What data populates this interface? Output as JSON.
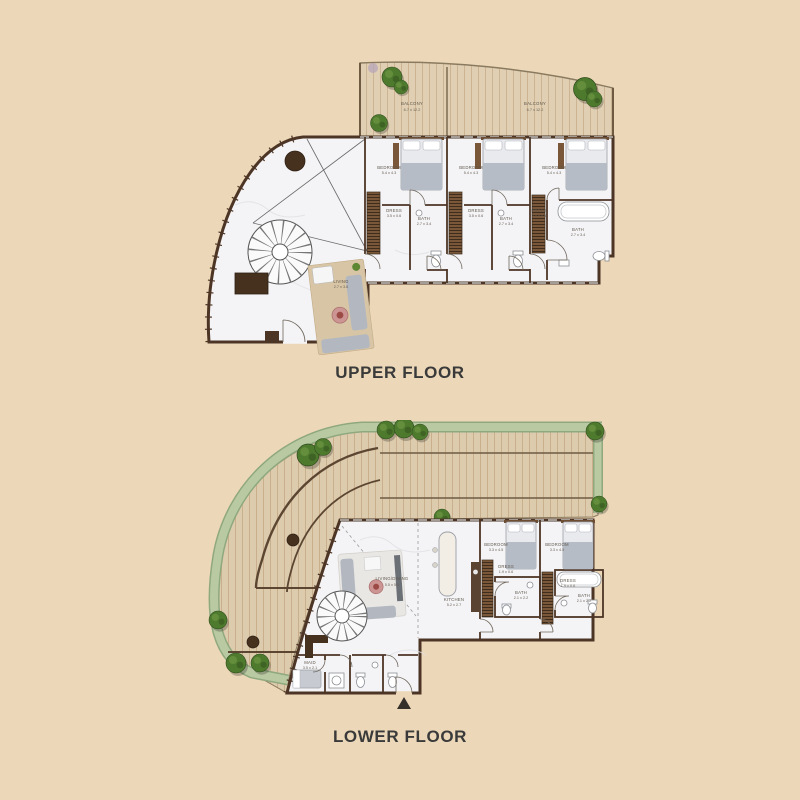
{
  "background": "#ecd8b8",
  "upper": {
    "title": "UPPER FLOOR",
    "rooms": {
      "balcony_left": {
        "label": "BALCONY",
        "dims": "6.7 x 12.2"
      },
      "balcony_right": {
        "label": "BALCONY",
        "dims": "6.7 x 12.2"
      },
      "bedroom_1": {
        "label": "BEDROOM",
        "dims": "5.4 x 4.3"
      },
      "bedroom_2": {
        "label": "BEDROOM",
        "dims": "5.4 x 4.3"
      },
      "bedroom_3": {
        "label": "BEDROOM",
        "dims": "5.4 x 4.3"
      },
      "dress_1": {
        "label": "DRESS",
        "dims": "3.5 x 0.6"
      },
      "dress_2": {
        "label": "DRESS",
        "dims": "3.5 x 0.6"
      },
      "dress_3": {
        "label": "DRESS",
        "dims": "3.5 x 0.6"
      },
      "bath_1": {
        "label": "BATH",
        "dims": "2.7 x 3.4"
      },
      "bath_2": {
        "label": "BATH",
        "dims": "2.7 x 3.4"
      },
      "bath_3": {
        "label": "BATH",
        "dims": "2.7 x 3.4"
      },
      "living": {
        "label": "LIVING",
        "dims": "2.7 x 3.8"
      }
    }
  },
  "lower": {
    "title": "LOWER FLOOR",
    "rooms": {
      "living_dining": {
        "label": "LIVING/DINING",
        "dims": "5.5 x 5.8"
      },
      "kitchen": {
        "label": "KITCHEN",
        "dims": "5.2 x 2.7"
      },
      "bedroom_1": {
        "label": "BEDROOM",
        "dims": "3.3 x 4.5"
      },
      "bedroom_2": {
        "label": "BEDROOM",
        "dims": "3.3 x 4.5"
      },
      "dress_1": {
        "label": "DRESS",
        "dims": "1.9 x 0.6"
      },
      "dress_2": {
        "label": "DRESS",
        "dims": "1.9 x 0.6"
      },
      "bath_1": {
        "label": "BATH",
        "dims": "2.1 x 2.2"
      },
      "bath_2": {
        "label": "BATH",
        "dims": "2.1 x 2.2"
      },
      "maid": {
        "label": "MAID",
        "dims": "3.5 x 2.1"
      }
    }
  }
}
